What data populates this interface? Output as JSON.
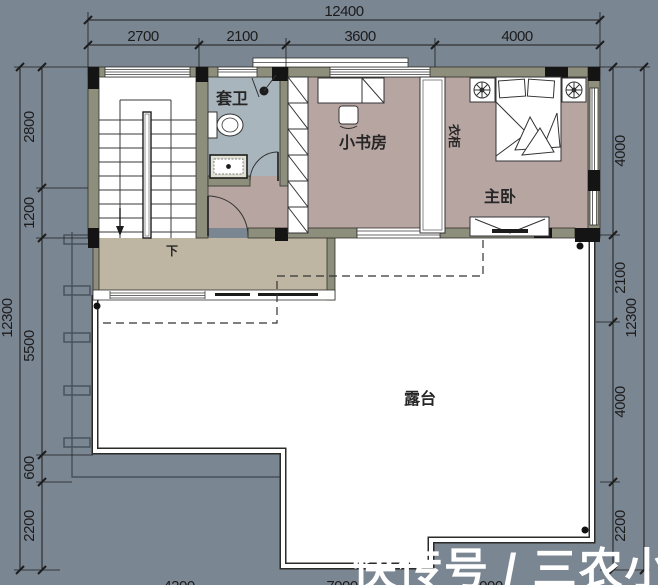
{
  "plan": {
    "labels": {
      "bathroom": "套卫",
      "study": "小书房",
      "wardrobe": "衣柜",
      "master_bedroom": "主卧",
      "stairs_down": "下",
      "terrace": "露台"
    },
    "dimensions": {
      "top": {
        "total": "12400",
        "segments": [
          "2700",
          "2100",
          "3600",
          "4000"
        ]
      },
      "left": {
        "total": "12300",
        "segments": [
          "2800",
          "1200",
          "5500",
          "600",
          "2200"
        ]
      },
      "right": {
        "total": "12300",
        "segments": [
          "4000",
          "2100",
          "4000",
          "2200"
        ]
      },
      "bottom": {
        "segments": [
          "4200",
          "7000",
          "4000"
        ]
      }
    },
    "colors": {
      "background": "#7b8693",
      "wall": "#8e8e7c",
      "bedroom_floor": "#b6a5a1",
      "bathroom_floor": "#a9b5bd",
      "corridor_floor": "#beb6a3",
      "terrace_floor": "#ffffff"
    }
  },
  "watermark": {
    "text": "快传号 / 三农小姝艳"
  }
}
